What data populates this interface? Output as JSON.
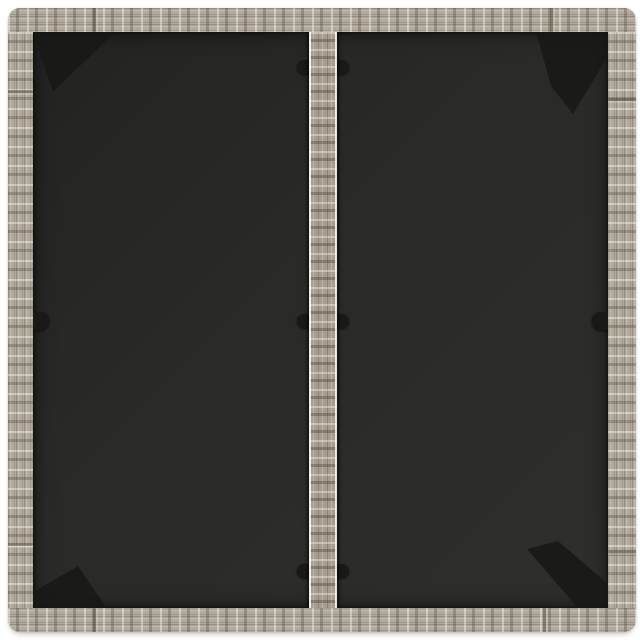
{
  "scene": {
    "type": "product-photo",
    "subject": "top-down view of a square outdoor table with gray poly-rattan woven frame and two dark tempered-glass panels separated by a woven centre strip",
    "background_color": "#ffffff"
  },
  "palette": {
    "background": "#ffffff",
    "rattan_base": "#b2aa9d",
    "rattan_strip_base": "#a89e90",
    "rattan_highlight": "#ece8de",
    "rattan_shadow": "#71695c",
    "seam": "#5a5244",
    "glass_dark": "#232321",
    "glass_light": "#2e2e2c",
    "bracket_shadow": "#171715",
    "clip": "#1b1917"
  },
  "parts": {
    "frame": "woven gray poly-rattan border frame with segment joints",
    "glass_panels": 2,
    "center_strip": "woven rattan divider between the two glass panels",
    "glass_clips_on_strip": 3,
    "glass_clips_on_sides": 2,
    "corner_bracket_shadows": 4
  }
}
